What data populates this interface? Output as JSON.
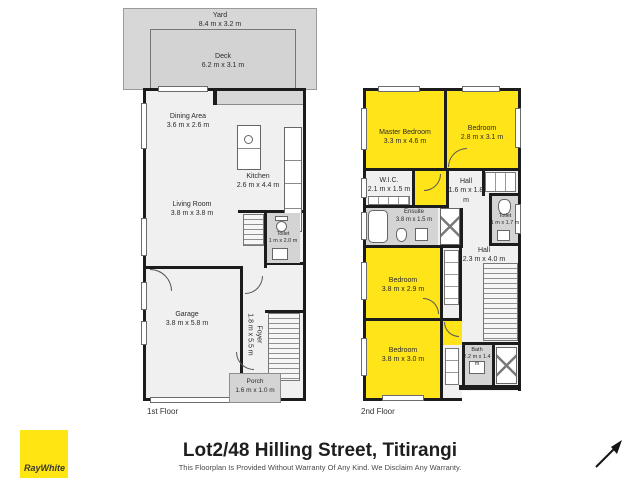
{
  "footer": {
    "title": "Lot2/48 Hilling Street, Titirangi",
    "disclaimer": "This Floorplan Is Provided Without Warranty Of Any Kind. We Disclaim Any Warranty."
  },
  "branding": {
    "logo_text": "RayWhite",
    "logo_color": "#ffe512"
  },
  "floor1": {
    "label": "1st Floor",
    "yard": {
      "name": "Yard",
      "dims": "8.4 m x 3.2 m"
    },
    "deck": {
      "name": "Deck",
      "dims": "6.2 m x 3.1 m"
    },
    "dining": {
      "name": "Dining Area",
      "dims": "3.6 m x 2.6 m"
    },
    "kitchen": {
      "name": "Kitchen",
      "dims": "2.6 m x 4.4 m"
    },
    "living": {
      "name": "Living Room",
      "dims": "3.8 m x 3.8 m"
    },
    "toilet": {
      "name": "Toilet",
      "dims": "1 m x 2.0 m"
    },
    "garage": {
      "name": "Garage",
      "dims": "3.8 m x 5.8 m"
    },
    "foyer": {
      "name": "Foyer",
      "dims": "1.8 m x 5.5 m"
    },
    "porch": {
      "name": "Porch",
      "dims": "1.6 m x 1.0 m"
    }
  },
  "floor2": {
    "label": "2nd Floor",
    "master": {
      "name": "Master Bedroom",
      "dims": "3.3 m x 4.6 m"
    },
    "bedroom_top": {
      "name": "Bedroom",
      "dims": "2.8 m x 3.1 m"
    },
    "wic": {
      "name": "W.I.C.",
      "dims": "2.1 m x 1.5 m"
    },
    "hall_top": {
      "name": "Hall",
      "dims": "1.6 m x 1.8 m"
    },
    "ensuite": {
      "name": "Ensuite",
      "dims": "3.8 m x 1.5 m"
    },
    "toilet": {
      "name": "Toilet",
      "dims": "1 m x 1.7 m"
    },
    "hall": {
      "name": "Hall",
      "dims": "2.3 m x 4.0 m"
    },
    "bedroom_mid": {
      "name": "Bedroom",
      "dims": "3.8 m x 2.9 m"
    },
    "bedroom_bottom": {
      "name": "Bedroom",
      "dims": "3.8 m x 3.0 m"
    },
    "bath": {
      "name": "Bath",
      "dims": "2.2 m x 1.4 m"
    }
  },
  "colors": {
    "highlight": "#ffe41a",
    "outdoor": "#d7d7d7",
    "wet": "#d4d4d4",
    "floor": "#f0f0f0",
    "wall": "#1c1c1c"
  }
}
